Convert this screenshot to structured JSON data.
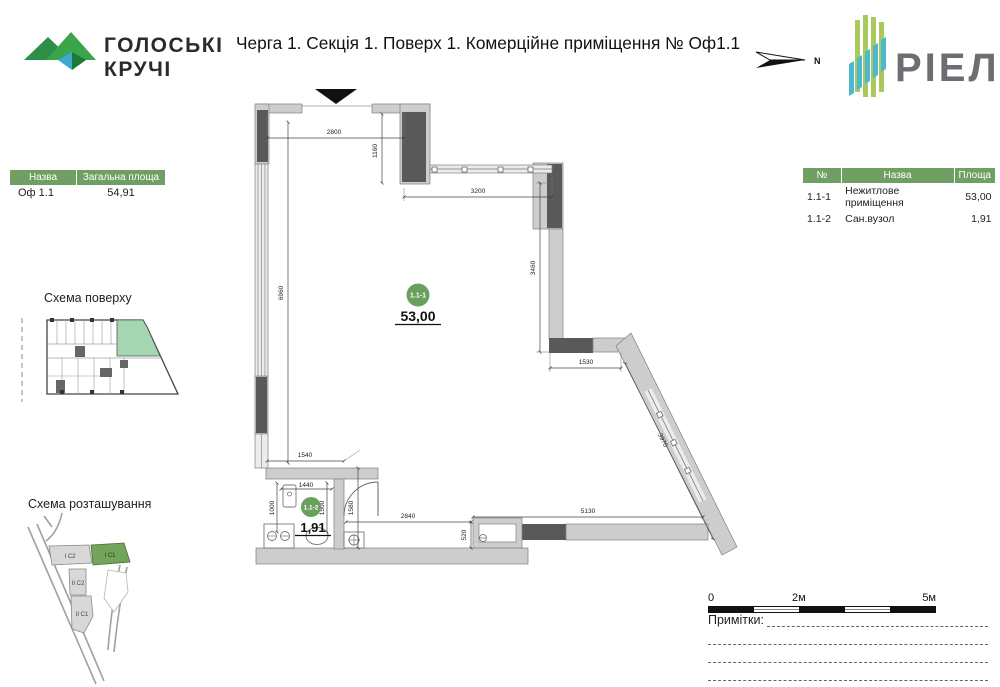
{
  "header": {
    "brand_line1": "ГОЛОСЬКІ",
    "brand_line2": "КРУЧІ",
    "title": "Черга 1. Секція 1. Поверх 1. Комерційне приміщення № Оф1.1",
    "north_label": "N",
    "logo_text": "РІЕЛ"
  },
  "left_table": {
    "headers": [
      "Назва",
      "Загальна площа"
    ],
    "rows": [
      [
        "Оф 1.1",
        "54,91"
      ]
    ]
  },
  "right_table": {
    "headers": [
      "№",
      "Назва",
      "Площа"
    ],
    "rows": [
      [
        "1.1-1",
        "Нежитлове приміщення",
        "53,00"
      ],
      [
        "1.1-2",
        "Сан.вузол",
        "1,91"
      ]
    ]
  },
  "floor_scheme": {
    "label": "Схема поверху"
  },
  "site_scheme": {
    "label": "Схема розташування",
    "buildings": [
      {
        "name": "І С2",
        "highlighted": false
      },
      {
        "name": "І С1",
        "highlighted": true
      },
      {
        "name": "ІІ С2",
        "highlighted": false
      },
      {
        "name": "ІІ С1",
        "highlighted": false
      }
    ]
  },
  "plan": {
    "rooms": [
      {
        "id": "1.1-1",
        "area": "53,00"
      },
      {
        "id": "1.1-2",
        "area": "1,91"
      }
    ],
    "dims": {
      "d2800": "2800",
      "d1160": "1160",
      "d3200": "3200",
      "d3460": "3460",
      "d6960": "6960",
      "d1530": "1530",
      "d3970": "3970",
      "d1540": "1540",
      "d1440": "1440",
      "d1000": "1000",
      "d1500": "1500",
      "d1580": "1580",
      "d2840": "2840",
      "d520": "520",
      "d5130": "5130"
    }
  },
  "scale_bar": {
    "labels": [
      "0",
      "2м",
      "5м"
    ]
  },
  "notes": {
    "label": "Примітки:"
  },
  "colors": {
    "accent_green": "#6f9f62",
    "unit_highlight": "#a3d6b1",
    "room_badge": "#69a05e",
    "wall_dark": "#595959",
    "wall_light": "#cdcdcd",
    "logo_green": "#a9c85d",
    "logo_teal": "#4fb8cf"
  }
}
